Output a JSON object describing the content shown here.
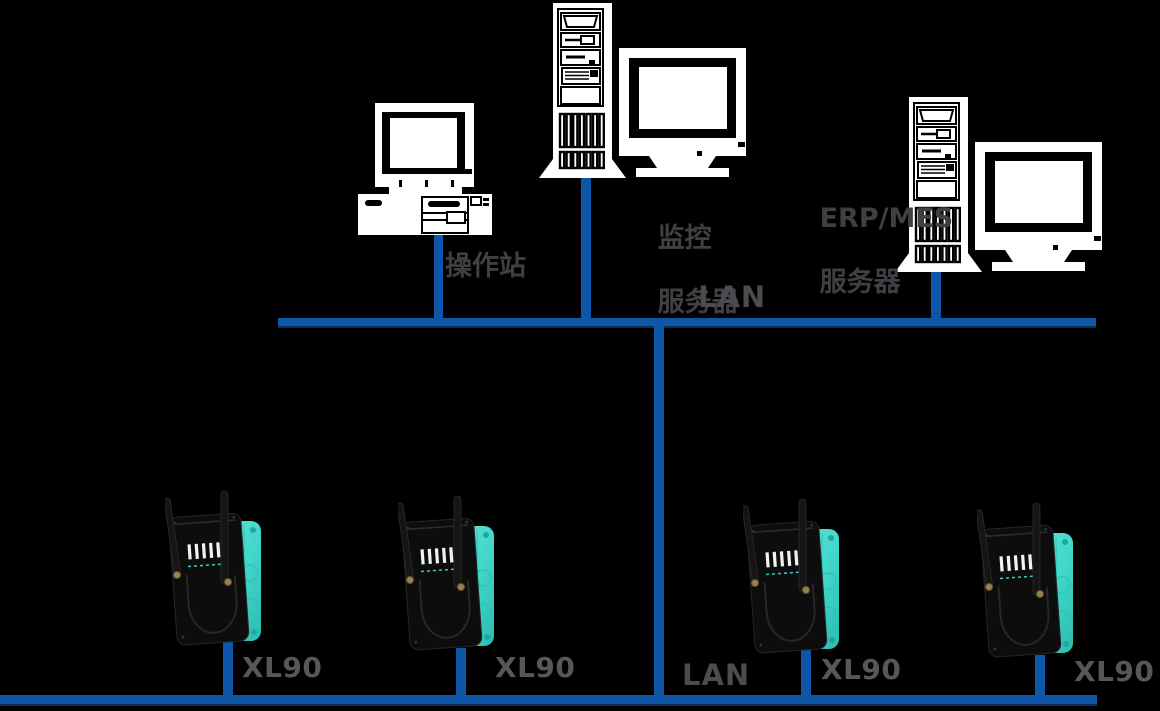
{
  "diagram": {
    "title_hint": "XL90 wireless industrial network topology",
    "colors": {
      "background": "#000000",
      "lan_line_blue": "#0e56a8",
      "lan_line_shadow": "#0a3566",
      "cjk_label_gray": "#3f4043",
      "lan_label_gray": "#4b4c50",
      "device_label_gray": "#56575b",
      "device_teal": "#43d8cc",
      "device_black": "#0d0d0d",
      "computer_white": "#ffffff"
    },
    "labels": {
      "operator_station": "操作站",
      "monitoring_server_line1": "监控",
      "monitoring_server_line2": "服务器",
      "erp_server_line1": "ERP/MES",
      "erp_server_line2": "服务器",
      "lan_top": "LAN",
      "lan_bottom": "LAN",
      "xl90_devices": [
        {
          "label": "XL90"
        },
        {
          "label": "XL90"
        },
        {
          "label": "XL90"
        },
        {
          "label": "XL90"
        }
      ]
    }
  }
}
